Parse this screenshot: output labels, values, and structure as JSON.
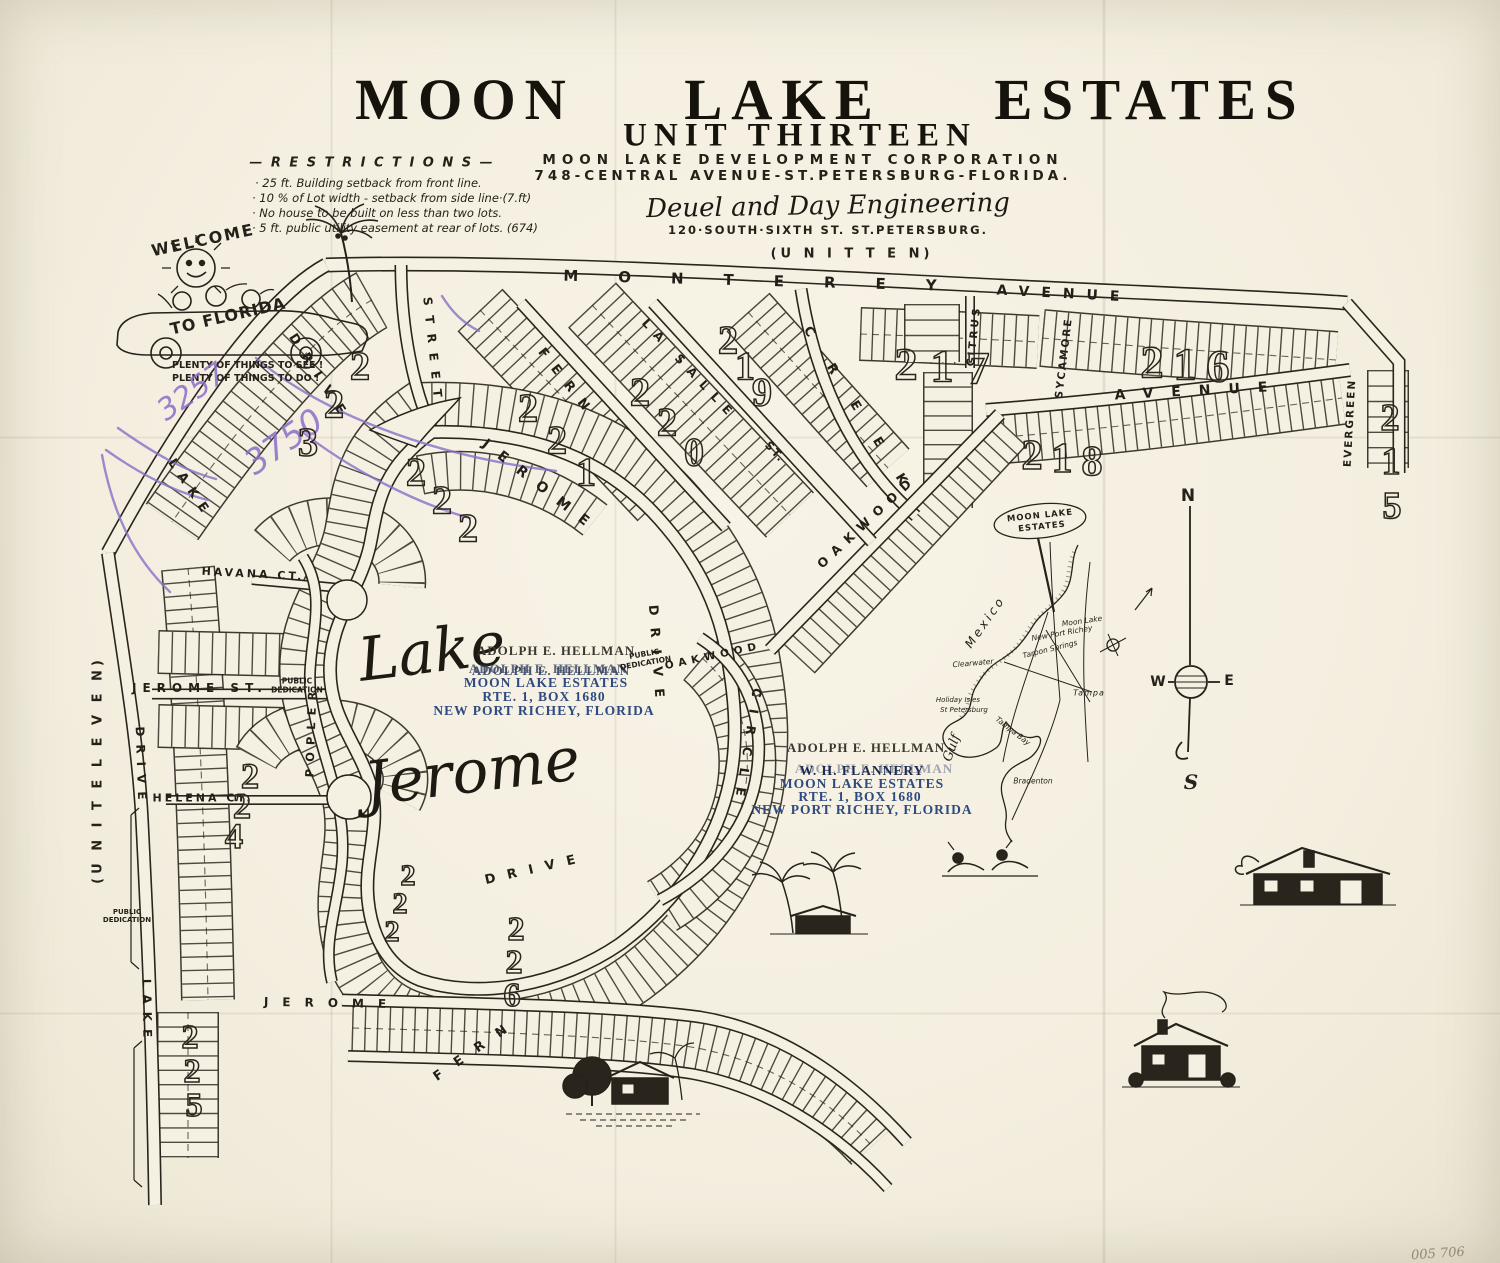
{
  "header": {
    "title_words": [
      "MOON",
      "LAKE",
      "ESTATES"
    ],
    "subtitle": "UNIT THIRTEEN",
    "corp_line1": "MOON LAKE DEVELOPMENT CORPORATION",
    "corp_line2": "748-CENTRAL AVENUE-ST.PETERSBURG-FLORIDA.",
    "engineer_script": "Deuel and Day Engineering",
    "engineer_addr": "120·SOUTH·SIXTH ST.      ST.PETERSBURG.",
    "unit_note": "(U N I T   T E N)"
  },
  "restrictions": {
    "heading": "— R E S T R I C T I O N S —",
    "items": [
      "· 25 ft. Building setback from front line.",
      "· 10 % of Lot width - setback from side line·(7.ft)",
      "· No house to be built on less than two lots.",
      "· 5 ft. public utility easement at rear of lots. (674)"
    ]
  },
  "welcome": {
    "arc_top": "WELCOME",
    "arc_bottom": "TO FLORIDA",
    "caption_line1": "PLENTY OF THINGS TO SEE !",
    "caption_line2": "PLENTY OF THINGS TO DO !"
  },
  "annotations": {
    "purple_1": "3257",
    "purple_2": "3750",
    "pencil_number": "005 706",
    "ink_color": "#8a6fc8"
  },
  "stamps": {
    "printed_name": "ADOLPH E. HELLMAN",
    "stamp1_name": "ADOLPH E. HELLMAN",
    "stamp2_name": "W. H. FLANNERY",
    "line2": "MOON LAKE ESTATES",
    "line3": "RTE. 1, BOX 1680",
    "line4": "NEW PORT RICHEY, FLORIDA",
    "color": "#2e4a80"
  },
  "lake_label": {
    "word1": "Lake",
    "word2": "Jerome"
  },
  "unit_eleven": "(U N I T   E L E V E N)",
  "block_numbers": [
    {
      "id": "b215",
      "n": "215"
    },
    {
      "id": "b216",
      "n": "216"
    },
    {
      "id": "b217",
      "n": "217"
    },
    {
      "id": "b218",
      "n": "218"
    },
    {
      "id": "b219",
      "n": "219"
    },
    {
      "id": "b220",
      "n": "220"
    },
    {
      "id": "b221",
      "n": "221"
    },
    {
      "id": "b222",
      "n": "222"
    },
    {
      "id": "b223",
      "n": "223"
    },
    {
      "id": "b222b",
      "n": "222"
    },
    {
      "id": "b224",
      "n": "224"
    },
    {
      "id": "b225",
      "n": "225"
    },
    {
      "id": "b226",
      "n": "226"
    }
  ],
  "streets": [
    {
      "id": "monterey",
      "label": "MONTEREY"
    },
    {
      "id": "avenue_top",
      "label": "AVENUE"
    },
    {
      "id": "citrus",
      "label": "CITRUS"
    },
    {
      "id": "sycamore",
      "label": "SYCAMORE"
    },
    {
      "id": "avenue_mid",
      "label": "AVENUE"
    },
    {
      "id": "evergreen",
      "label": "EVERGREEN"
    },
    {
      "id": "creek",
      "label": "CREEK"
    },
    {
      "id": "oakwood",
      "label": "OAKWOOD"
    },
    {
      "id": "oakwood2",
      "label": "OAKWOOD"
    },
    {
      "id": "la_salle",
      "label": "LA SALLE"
    },
    {
      "id": "la_salle_st",
      "label": "ST."
    },
    {
      "id": "fern_upper",
      "label": "FERN"
    },
    {
      "id": "street_upper",
      "label": "STREET"
    },
    {
      "id": "jerome_loop",
      "label": "JEROME"
    },
    {
      "id": "drive_east",
      "label": "DRIVE"
    },
    {
      "id": "circle_label",
      "label": "CIRCLE"
    },
    {
      "id": "drive_south",
      "label": "DRIVE"
    },
    {
      "id": "lake_top",
      "label": "LAKE"
    },
    {
      "id": "drive_top",
      "label": "DRIVE"
    },
    {
      "id": "drive_left",
      "label": "DRIVE"
    },
    {
      "id": "lake_left",
      "label": "LAKE"
    },
    {
      "id": "jerome_st_label",
      "label": "JEROME  ST."
    },
    {
      "id": "havana",
      "label": "HAVANA CT."
    },
    {
      "id": "helena",
      "label": "HELENA CT."
    },
    {
      "id": "popler",
      "label": "POPLER"
    },
    {
      "id": "jerome_bottom",
      "label": "JEROME"
    },
    {
      "id": "fern_bottom",
      "label": "FERN"
    },
    {
      "id": "pd1",
      "label": "PUBLIC DEDICATION"
    },
    {
      "id": "pd2",
      "label": "PUBLIC DEDICATION"
    },
    {
      "id": "pd3",
      "label": "PUBLIC DEDICATION"
    }
  ],
  "inset": {
    "sign_line1": "MOON LAKE",
    "sign_line2": "ESTATES",
    "mexico": "Mexico",
    "gulf": "Gulf",
    "moon_lake": "Moon Lake",
    "new_port_richey": "New Port Richey",
    "tarpon_springs": "Tarpon Springs",
    "clearwater": "Clearwater",
    "holiday_isles": "Holiday Isles",
    "st_petersburg": "St Petersburg",
    "tampa": "Tampa",
    "tampa_bay": "Tampa Bay",
    "bradenton": "Bradenton"
  },
  "compass": {
    "n": "N",
    "s": "S",
    "e": "E",
    "w": "W"
  }
}
